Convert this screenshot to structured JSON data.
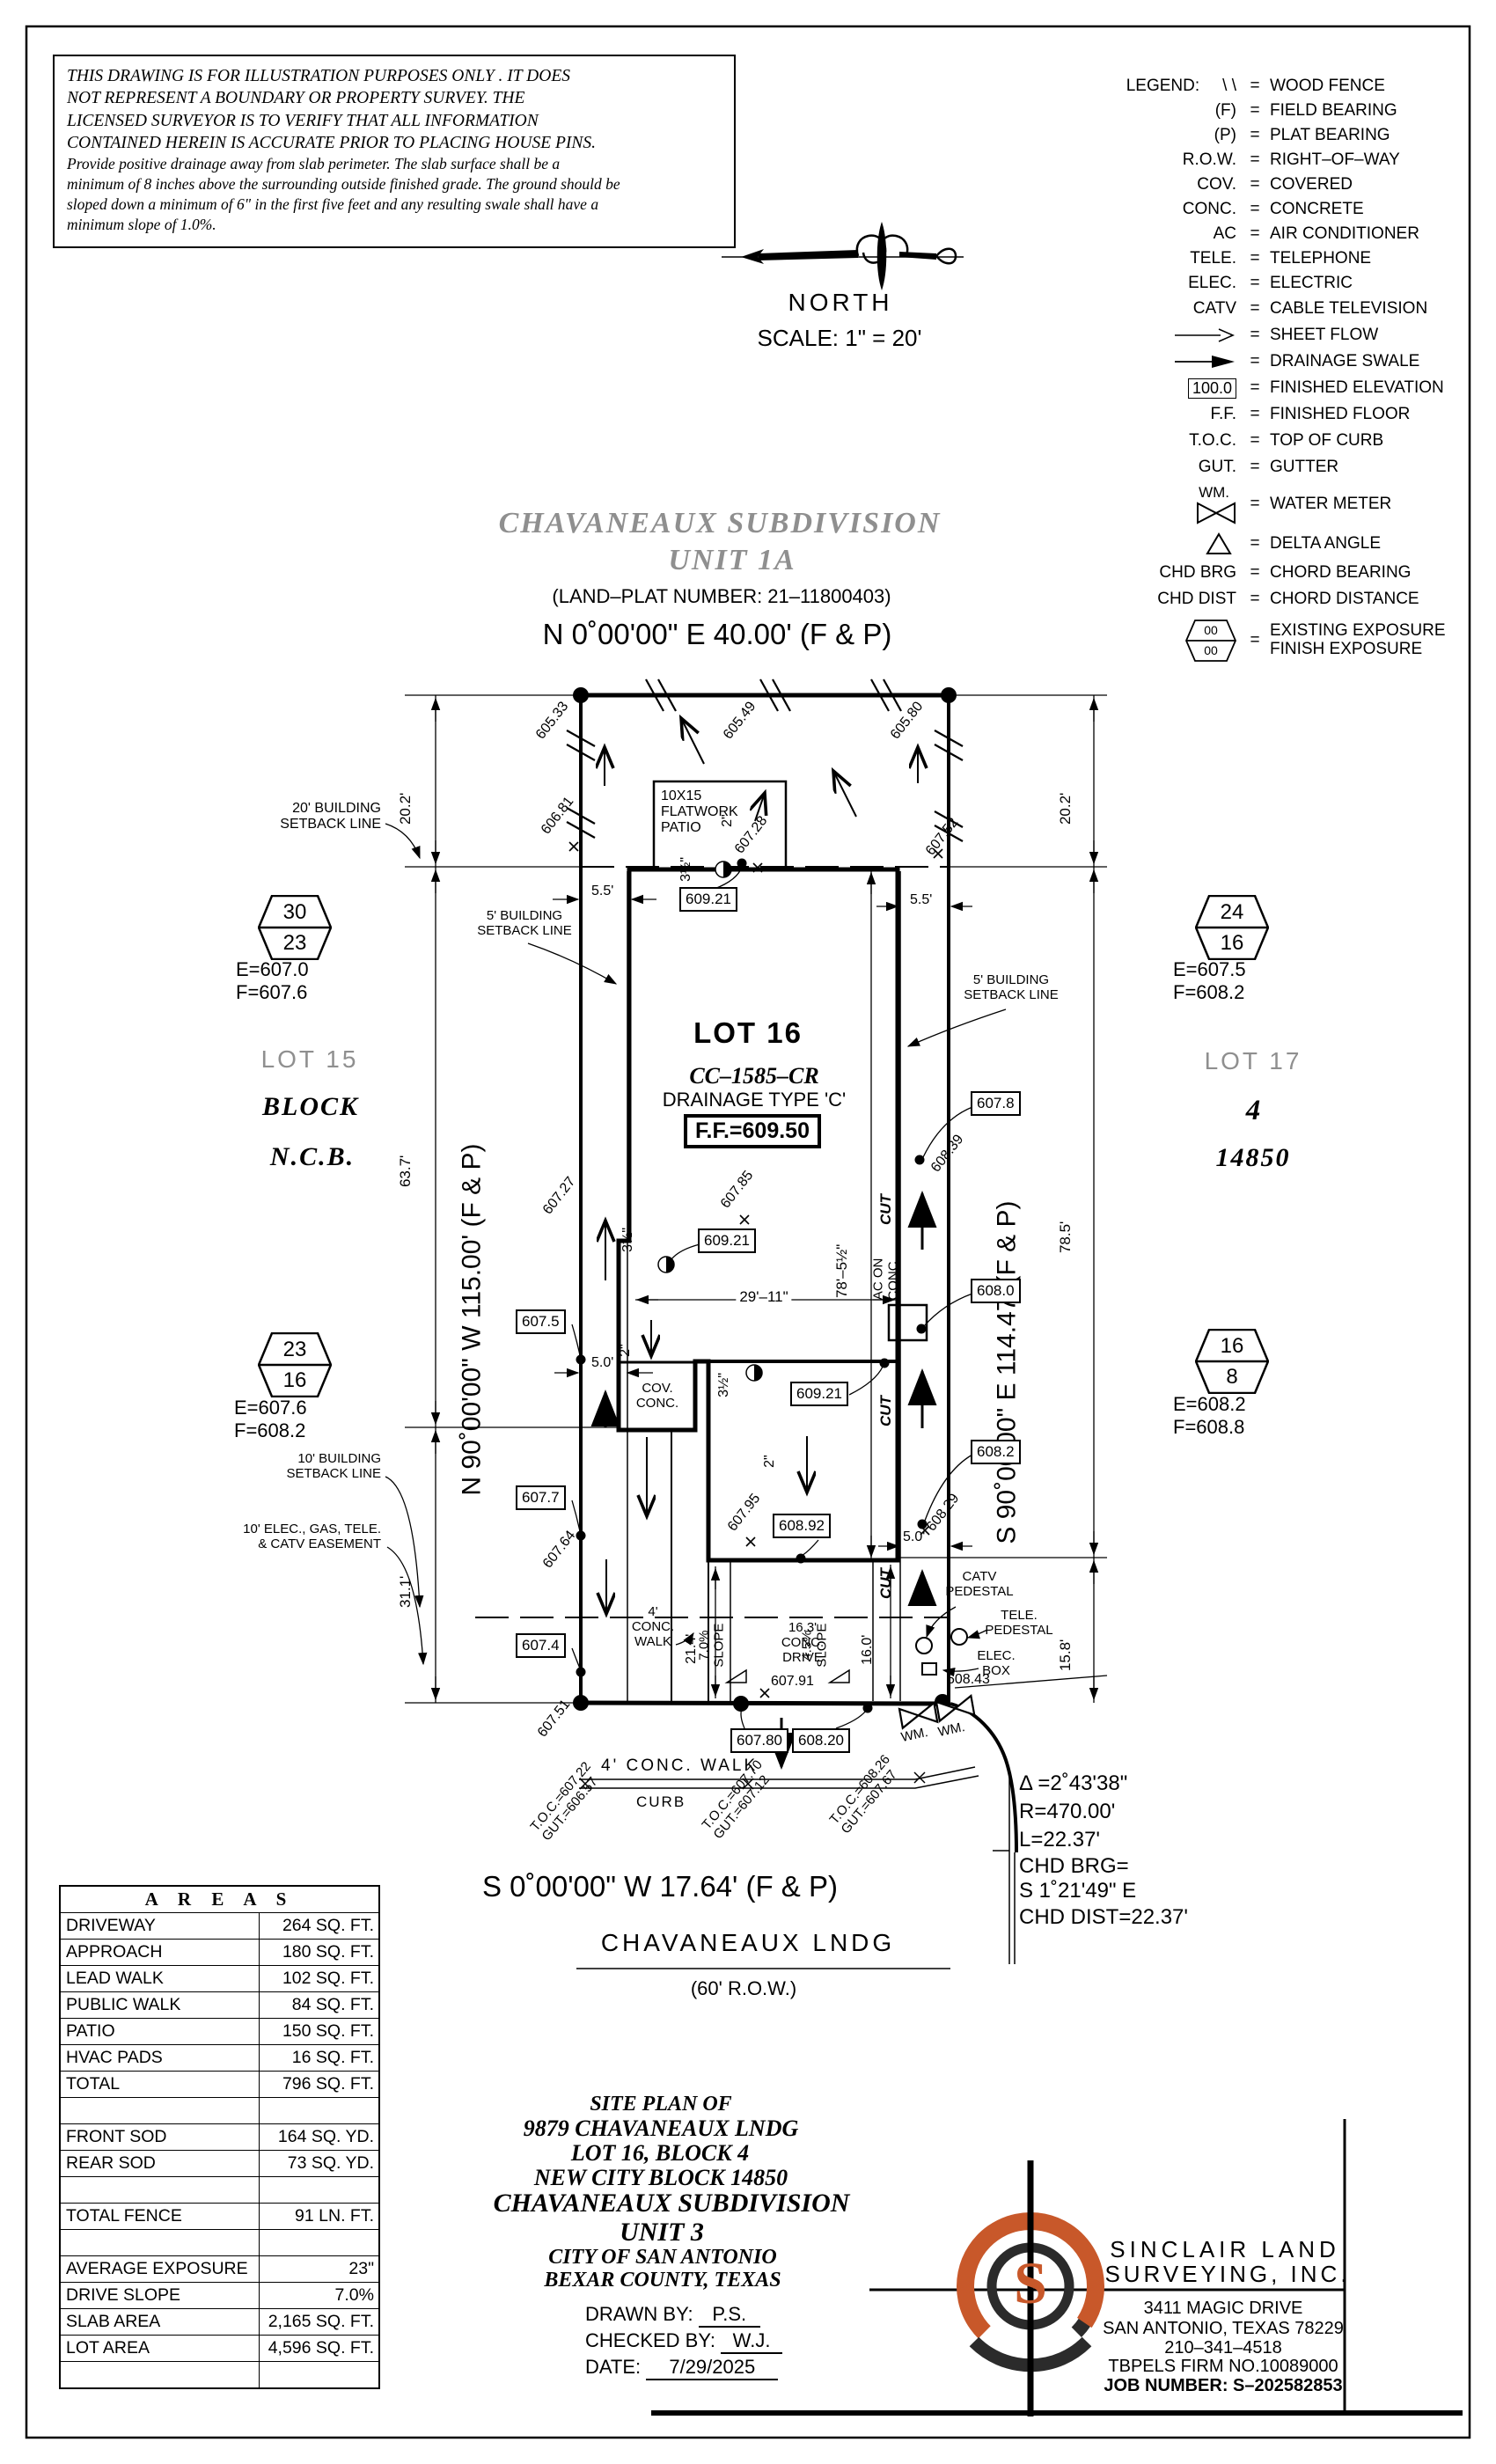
{
  "colors": {
    "accent": "#c8582a",
    "gray_title": "#8f8f8f"
  },
  "disclaimer": {
    "para1": [
      "THIS DRAWING IS FOR ILLUSTRATION PURPOSES ONLY . IT DOES",
      "NOT REPRESENT A BOUNDARY OR PROPERTY SURVEY. THE",
      "LICENSED SURVEYOR IS TO VERIFY THAT ALL INFORMATION",
      "CONTAINED HEREIN IS ACCURATE PRIOR TO PLACING HOUSE PINS."
    ],
    "para2": [
      "Provide positive drainage away from slab perimeter. The slab surface shall be a",
      "minimum of 8 inches above the surrounding outside finished grade. The ground should be",
      "sloped down a minimum of 6\" in the first five feet and any resulting swale shall have a",
      "minimum slope of 1.0%."
    ]
  },
  "compass": {
    "north": "NORTH",
    "scale": "SCALE:  1\" =  20'"
  },
  "header": {
    "title1": "CHAVANEAUX  SUBDIVISION",
    "title2": "UNIT  1A",
    "plat_number": "(LAND–PLAT NUMBER:  21–11800403)"
  },
  "legend": {
    "label": "LEGEND:",
    "eq": "=",
    "hex_top": "00",
    "hex_bot": "00",
    "wm_sym": "WM.",
    "finished_elev_sym": "100.0",
    "rows": [
      {
        "sym": "\\ \\",
        "desc": "WOOD FENCE"
      },
      {
        "sym": "(F)",
        "desc": "FIELD BEARING"
      },
      {
        "sym": "(P)",
        "desc": "PLAT BEARING"
      },
      {
        "sym": "R.O.W.",
        "desc": "RIGHT–OF–WAY"
      },
      {
        "sym": "COV.",
        "desc": "COVERED"
      },
      {
        "sym": "CONC.",
        "desc": "CONCRETE"
      },
      {
        "sym": "AC",
        "desc": "AIR CONDITIONER"
      },
      {
        "sym": "TELE.",
        "desc": "TELEPHONE"
      },
      {
        "sym": "ELEC.",
        "desc": "ELECTRIC"
      },
      {
        "sym": "CATV",
        "desc": "CABLE TELEVISION"
      },
      {
        "sym": "",
        "desc": "SHEET FLOW"
      },
      {
        "sym": "",
        "desc": "DRAINAGE SWALE"
      },
      {
        "sym": "",
        "desc": "FINISHED ELEVATION"
      },
      {
        "sym": "F.F.",
        "desc": "FINISHED FLOOR"
      },
      {
        "sym": "T.O.C.",
        "desc": "TOP OF CURB"
      },
      {
        "sym": "GUT.",
        "desc": "GUTTER"
      },
      {
        "sym": "",
        "desc": "WATER METER"
      },
      {
        "sym": "",
        "desc": "DELTA ANGLE"
      },
      {
        "sym": "CHD BRG",
        "desc": "CHORD BEARING"
      },
      {
        "sym": "CHD DIST",
        "desc": "CHORD DISTANCE"
      },
      {
        "sym": "",
        "desc": "EXISTING EXPOSURE",
        "desc2": "FINISH EXPOSURE"
      }
    ]
  },
  "plat": {
    "bearing_top": "N 0˚00'00\" E 40.00' (F & P)",
    "bearing_left": "N 90˚00'00\" W 115.00' (F & P)",
    "bearing_right": "S 90˚00'00\" E 114.47' (F & P)",
    "bearing_bottom": "S 0˚00'00\" W 17.64' (F & P)",
    "street": "CHAVANEAUX LNDG",
    "row_label": "(60' R.O.W.)",
    "lot_title": "LOT 16",
    "lot_code": "CC–1585–CR",
    "lot_drainage": "DRAINAGE TYPE 'C'",
    "ff": "F.F.=609.50",
    "neighbor_left": [
      "LOT 15",
      "BLOCK",
      "N.C.B."
    ],
    "neighbor_right": [
      "LOT 17",
      "4",
      "14850"
    ],
    "setback20": [
      "20' BUILDING",
      "SETBACK LINE"
    ],
    "setback5": [
      "5' BUILDING",
      "SETBACK LINE"
    ],
    "setback10": [
      "10' BUILDING",
      "SETBACK LINE"
    ],
    "easement": [
      "10' ELEC., GAS, TELE.",
      "& CATV EASEMENT"
    ],
    "patio": [
      "10X15",
      "FLATWORK",
      "PATIO"
    ],
    "cov_conc": [
      "COV.",
      "CONC."
    ],
    "ac": [
      "AC ON",
      "CONC."
    ],
    "walk_lead": [
      "4'",
      "CONC.",
      "WALK"
    ],
    "walk_public": "4' CONC. WALK",
    "curb": "CURB",
    "drive": [
      "16.3'",
      "CONC.",
      "DRIVE"
    ],
    "slope_left": [
      "7.0%",
      "SLOPE"
    ],
    "slope_right": [
      "4.5%",
      "SLOPE"
    ],
    "catv": [
      "CATV",
      "PEDESTAL"
    ],
    "tele": [
      "TELE.",
      "PEDESTAL"
    ],
    "elec": [
      "ELEC.",
      "BOX"
    ],
    "wm": "WM.",
    "cut": "CUT",
    "dims": {
      "d20_2": "20.2'",
      "d63_7": "63.7'",
      "d31_1": "31.1'",
      "d78_5": "78.5'",
      "d15_8": "15.8'",
      "d5_5": "5.5'",
      "d29_11": "29'–11\"",
      "d78_5h": "78'–5½\"",
      "d5_0": "5.0'",
      "d16_0": "16.0'",
      "d21_4": "21.4'",
      "d2in": "2\"",
      "d3_5in": "3½\""
    },
    "spots": {
      "s605_33": "605.33",
      "s605_49": "605.49",
      "s605_80": "605.80",
      "s606_81": "606.81",
      "s607_52": "607.52",
      "s607_28": "607.28",
      "s607_27": "607.27",
      "s607_64": "607.64",
      "s607_85": "607.85",
      "s607_95": "607.95",
      "s608_39": "608.39",
      "s608_29": "608.29",
      "s607_51": "607.51",
      "s607_91": "607.91",
      "s608_43": "608.43"
    },
    "boxes": {
      "b609_21": "609.21",
      "b607_5": "607.5",
      "b607_7": "607.7",
      "b607_4": "607.4",
      "b607_8": "607.8",
      "b608_0": "608.0",
      "b608_2": "608.2",
      "b608_92": "608.92",
      "b607_80": "607.80",
      "b608_20": "608.20"
    },
    "toc": [
      {
        "t": "T.O.C.=607.22",
        "g": "GUT.=606.57"
      },
      {
        "t": "T.O.C.=607.70",
        "g": "GUT.=607.12"
      },
      {
        "t": "T.O.C.=608.26",
        "g": "GUT.=607.67"
      }
    ],
    "curve": {
      "l1": "Δ =2˚43'38\"",
      "l2": "R=470.00'",
      "l3": "L=22.37'",
      "l4": "CHD BRG=",
      "l5": "S 1˚21'49\" E",
      "l6": "CHD DIST=22.37'"
    },
    "exposures": [
      {
        "top": "30",
        "bot": "23",
        "e": "E=607.0",
        "f": "F=607.6"
      },
      {
        "top": "23",
        "bot": "16",
        "e": "E=607.6",
        "f": "F=608.2"
      },
      {
        "top": "24",
        "bot": "16",
        "e": "E=607.5",
        "f": "F=608.2"
      },
      {
        "top": "16",
        "bot": "8",
        "e": "E=608.2",
        "f": "F=608.8"
      }
    ]
  },
  "areas": {
    "title": "A R E A S",
    "rows": [
      {
        "label": "DRIVEWAY",
        "value": "264 SQ. FT."
      },
      {
        "label": "APPROACH",
        "value": "180 SQ. FT."
      },
      {
        "label": "LEAD WALK",
        "value": "102 SQ. FT."
      },
      {
        "label": "PUBLIC WALK",
        "value": "84 SQ. FT."
      },
      {
        "label": "PATIO",
        "value": "150 SQ. FT."
      },
      {
        "label": "HVAC PADS",
        "value": "16 SQ. FT."
      },
      {
        "label": "TOTAL",
        "value": "796 SQ. FT."
      },
      {
        "label": "",
        "value": ""
      },
      {
        "label": "FRONT SOD",
        "value": "164 SQ. YD."
      },
      {
        "label": "REAR SOD",
        "value": "73 SQ. YD."
      },
      {
        "label": "",
        "value": ""
      },
      {
        "label": "TOTAL FENCE",
        "value": "91 LN. FT."
      },
      {
        "label": "",
        "value": ""
      },
      {
        "label": "AVERAGE EXPOSURE",
        "value": "23\""
      },
      {
        "label": "DRIVE SLOPE",
        "value": "7.0%"
      },
      {
        "label": "SLAB AREA",
        "value": "2,165 SQ. FT."
      },
      {
        "label": "LOT AREA",
        "value": "4,596 SQ. FT."
      },
      {
        "label": "",
        "value": ""
      }
    ]
  },
  "titleblock": {
    "l1": "SITE PLAN OF",
    "l2": "9879 CHAVANEAUX LNDG",
    "l3": "LOT 16, BLOCK 4",
    "l4": "NEW CITY BLOCK 14850",
    "l5": "CHAVANEAUX SUBDIVISION",
    "l6": "UNIT 3",
    "l7": "CITY OF SAN ANTONIO",
    "l8": "BEXAR COUNTY, TEXAS",
    "drawn_label": "DRAWN BY:",
    "drawn": "P.S.",
    "checked_label": "CHECKED BY:",
    "checked": "W.J.",
    "date_label": "DATE:",
    "date": "7/29/2025"
  },
  "firm": {
    "name1": "SINCLAIR LAND",
    "name2": "SURVEYING, INC.",
    "addr1": "3411 MAGIC DRIVE",
    "addr2": "SAN ANTONIO, TEXAS 78229",
    "phone": "210–341–4518",
    "firm_no": "TBPELS FIRM NO.10089000",
    "job": "JOB NUMBER: S–202582853",
    "logo_letter": "S"
  }
}
